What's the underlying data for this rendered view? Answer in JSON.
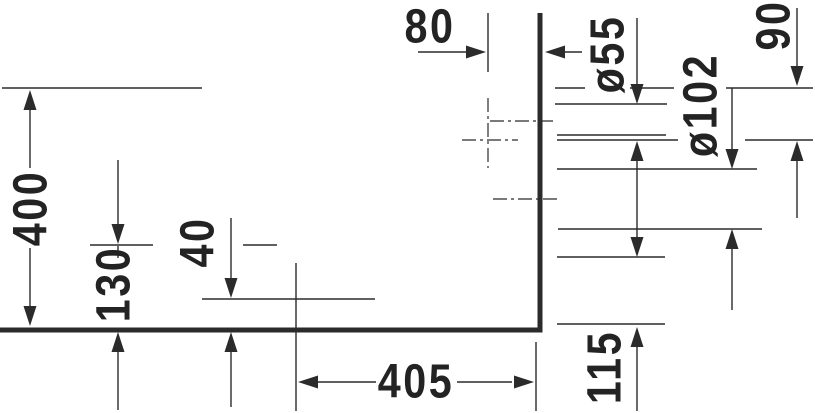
{
  "colors": {
    "line": "#2b2b2b",
    "text": "#232323",
    "background": "#ffffff"
  },
  "drawing": {
    "labels": {
      "d80": "80",
      "d55": "ø55",
      "d90": "90",
      "d102": "ø102",
      "d400": "400",
      "d130": "130",
      "d40": "40",
      "d405": "405",
      "d115": "115"
    }
  }
}
